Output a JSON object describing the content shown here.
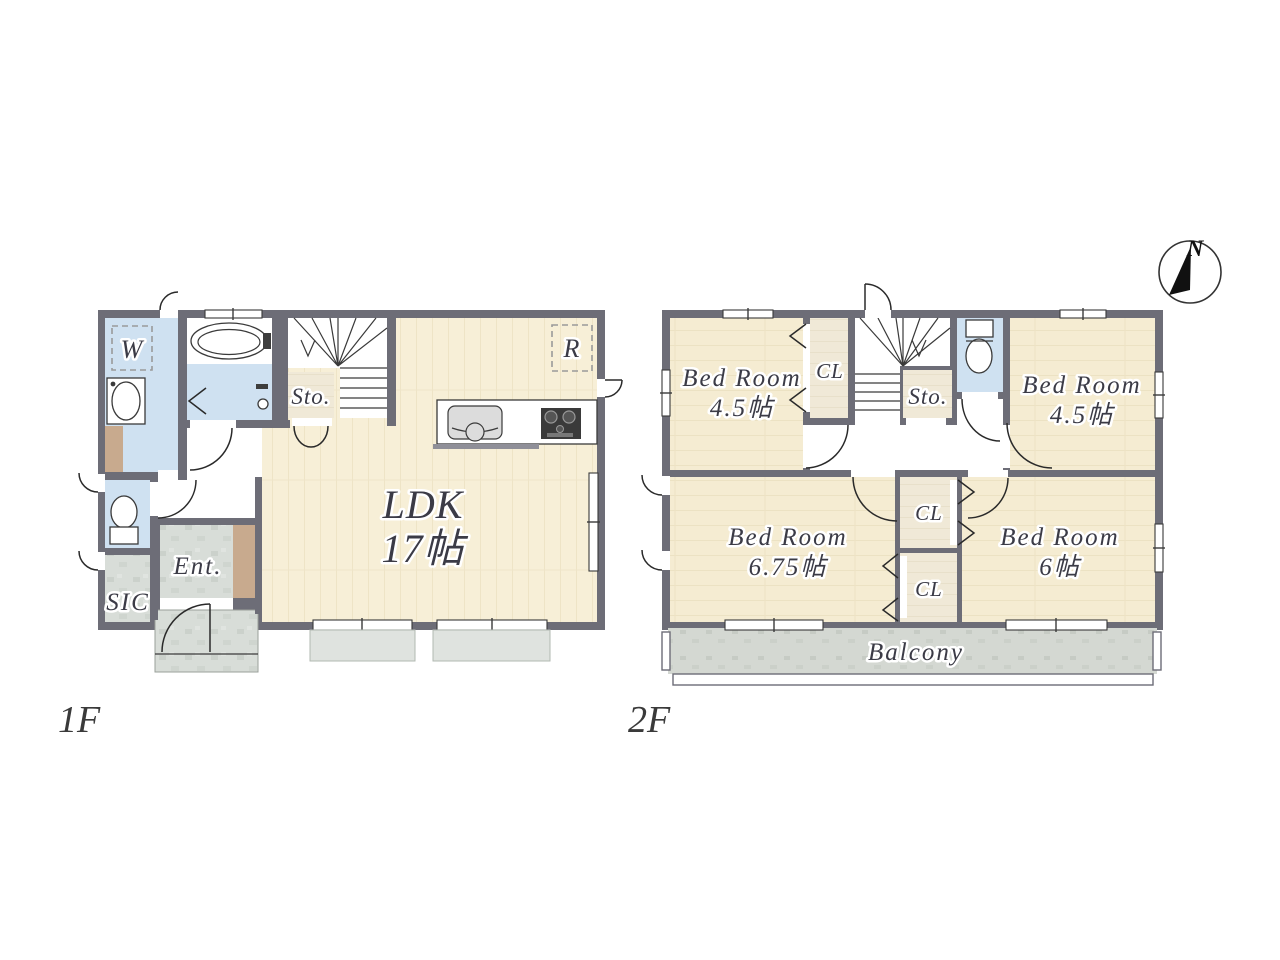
{
  "compass": {
    "north": "N"
  },
  "floor1": {
    "label": "1F",
    "washer": "W",
    "storage": "Sto.",
    "refrigerator": "R",
    "ldk_name": "LDK",
    "ldk_size": "17帖",
    "entrance": "Ent.",
    "shoe_closet": "SIC"
  },
  "floor2": {
    "label": "2F",
    "storage": "Sto.",
    "closet_top_left": "CL",
    "closet_mid_upper": "CL",
    "closet_mid_lower": "CL",
    "balcony": "Balcony",
    "bedroom_top_left": {
      "name": "Bed Room",
      "size": "4.5帖"
    },
    "bedroom_top_right": {
      "name": "Bed Room",
      "size": "4.5帖"
    },
    "bedroom_bottom_left": {
      "name": "Bed Room",
      "size": "6.75帖"
    },
    "bedroom_bottom_right": {
      "name": "Bed Room",
      "size": "6帖"
    }
  }
}
